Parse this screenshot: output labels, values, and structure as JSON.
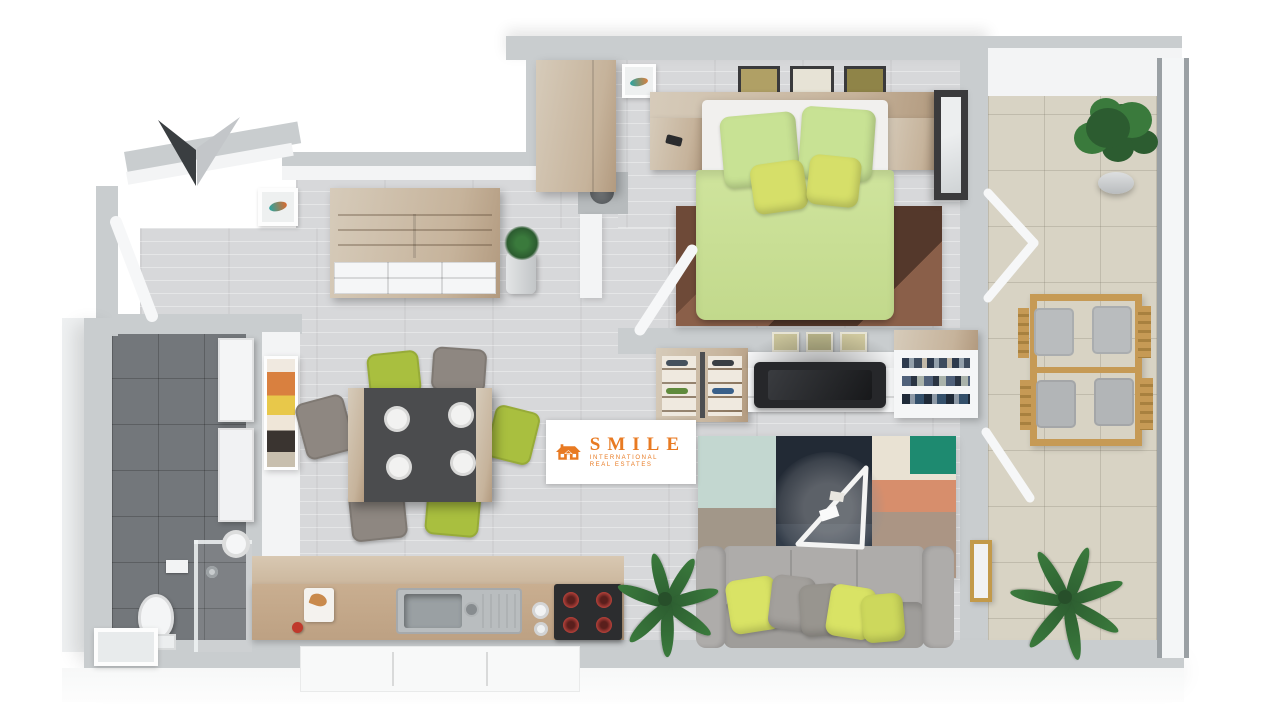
{
  "logo": {
    "brand": "SMILE",
    "line1": "INTERNATIONAL",
    "line2": "REAL ESTATES",
    "color": "#e87a22"
  },
  "compass": {
    "direction": "down-pointing-north-arrow",
    "dark": "#3a3e41",
    "light": "#c3c6c9"
  },
  "palette": {
    "page_bg": "#ffffff",
    "wall": "#c9cdcf",
    "wall_dark": "#b7bbbd",
    "wall_face": "#f3f4f5",
    "apron": "#eef0f1",
    "floor_wood": "#d7d8da",
    "bath_tile": "#73777b",
    "balcony_tile": "#d8d3c4",
    "wood_light": "#d6cbba",
    "wood_mid": "#c6b39b",
    "wood_dark": "#b29a7f",
    "duvet": "#cfe49d",
    "pillow": "#c8e294",
    "pillow_small": "#d6df69",
    "mattress": "#f1f0ee",
    "bed_rug1": "#6e4a38",
    "bed_rug2": "#8a5f49",
    "bed_rug3": "#54382b",
    "sofa": "#aeacaa",
    "sofa_dark": "#9f9d9a",
    "pillow_green": "#d9e365",
    "pillow_gray": "#a3a09c",
    "rug_mint": "#c3d7d0",
    "rug_navy": "#222a35",
    "rug_navy2": "#313b48",
    "rug_cream": "#e9e2d3",
    "rug_teal": "#1e8a70",
    "rug_salmon": "#d78e6c",
    "rug_taupe": "#ab9584",
    "rug_gray": "#a29789",
    "chair_green": "#a9bf3f",
    "chair_gray": "#8e8781",
    "table_top": "#4b4c4e",
    "plate": "#f2f2f1",
    "counter_wood": "#c9ae90",
    "steel": "#b9bdbf",
    "basin": "#9aa0a3",
    "cooktop": "#2c2d2f",
    "burner": "#b5413a",
    "white_furn": "#f5f6f7",
    "tv_black": "#26272a",
    "frame_dark": "#3a3a3c",
    "frame_gold": "#c39a4a",
    "plant": "#3a7a3c",
    "plant_dark": "#2c5c30",
    "logo_orange": "#e87a22",
    "balcony_wood": "#c69a55",
    "glass": "#f4f6f7",
    "rail": "#9aa0a4",
    "art_orange": "#d9803f",
    "art_yellow": "#e8c84a",
    "art_dark": "#3a3430"
  },
  "scene": {
    "type": "3d-floorplan-top-view",
    "rooms": [
      {
        "name": "entry-hall",
        "items": [
          "entrance-door",
          "wall-picture"
        ]
      },
      {
        "name": "bathroom",
        "items": [
          "washing-machine",
          "vanity-cabinet",
          "round-sink",
          "toilet",
          "shower",
          "window"
        ]
      },
      {
        "name": "living-dining-room",
        "items": [
          "sideboard-with-drawers",
          "potted-succulent",
          "dining-table",
          "six-chairs",
          "patchwork-rug",
          "glass-coffee-table",
          "sofa",
          "cushions",
          "floor-plant",
          "tv",
          "tv-cabinet",
          "shoe-shelf",
          "bookshelf",
          "wall-art",
          "gold-framed-picture"
        ]
      },
      {
        "name": "kitchen",
        "items": [
          "wood-counter",
          "steel-sink",
          "cooktop",
          "cutting-board",
          "base-cabinets"
        ]
      },
      {
        "name": "bedroom",
        "items": [
          "double-bed",
          "green-duvet",
          "four-pillows",
          "headboard",
          "two-nightstands",
          "wardrobe",
          "three-wall-pictures",
          "brown-rug",
          "dark-framed-mirror",
          "balcony-door"
        ]
      },
      {
        "name": "balcony",
        "items": [
          "potted-bush",
          "wooden-table",
          "four-cushioned-chairs",
          "palm-plant",
          "glass-railing"
        ]
      }
    ]
  }
}
